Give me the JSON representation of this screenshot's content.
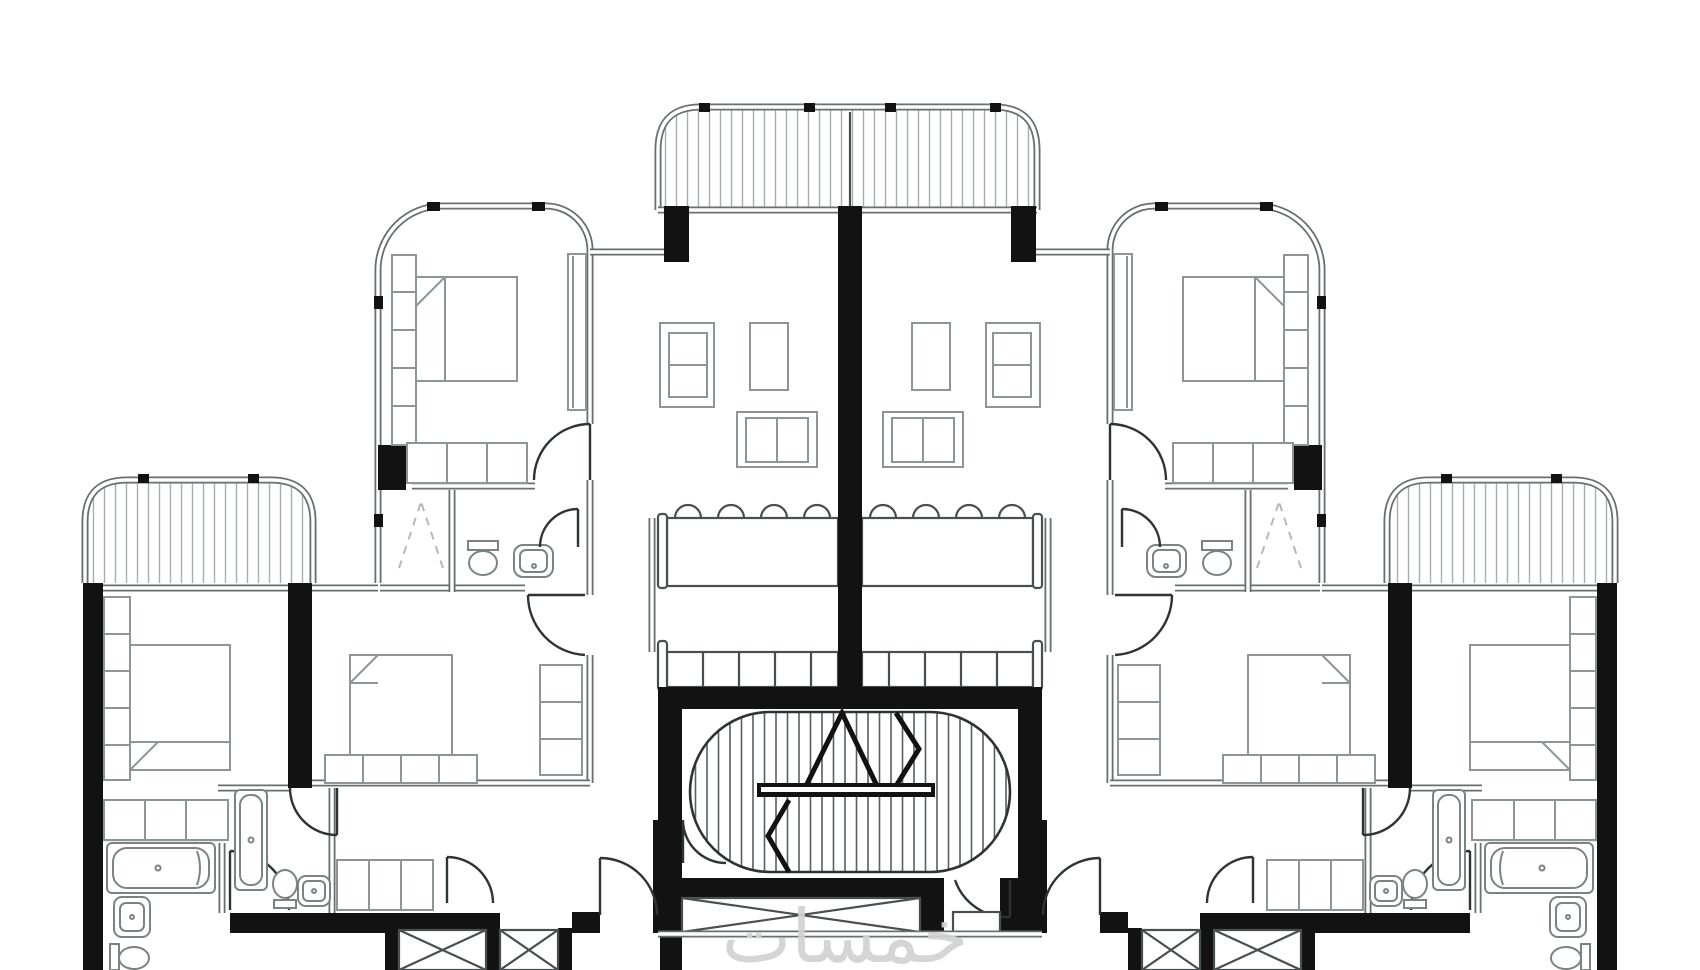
{
  "watermark": {
    "text": "خمسات"
  },
  "theme": {
    "colors": {
      "bg": "#ffffff",
      "wall": "#121212",
      "line": "#6a6e6e",
      "furniture": "#8f9494",
      "fixture": "#7d8282",
      "door": "#2f3333",
      "hatch": "#a9adad",
      "dash": "#b5b9b9",
      "counter": "#4a4e4e",
      "stair": "#5a5e5e",
      "watermark": "#d2d2d2"
    }
  },
  "plan": {
    "kind": "residential apartment floor plan (black-and-white architectural drawing)",
    "symmetry": "mirrored left/right about vertical center line",
    "units": 2,
    "balconies": 3,
    "rooms_per_unit": [
      "wing-bedroom",
      "ensuite-bathroom",
      "living-room",
      "dining-area",
      "kitchen",
      "bedroom-a",
      "bedroom-b",
      "bathroom-a",
      "bathroom-b"
    ],
    "shared_core": [
      "scissor-stair",
      "elevator",
      "corridor",
      "service-shafts"
    ],
    "furniture_counts": {
      "beds": 6,
      "double-armchairs": 2,
      "side-chairs": 2,
      "loveseats": 2,
      "dining-tables": 2,
      "dining-chairs": 8,
      "kitchen-counters": 2,
      "bathtubs": 4,
      "toilets": 6,
      "sinks": 6,
      "wardrobes": 8
    }
  }
}
